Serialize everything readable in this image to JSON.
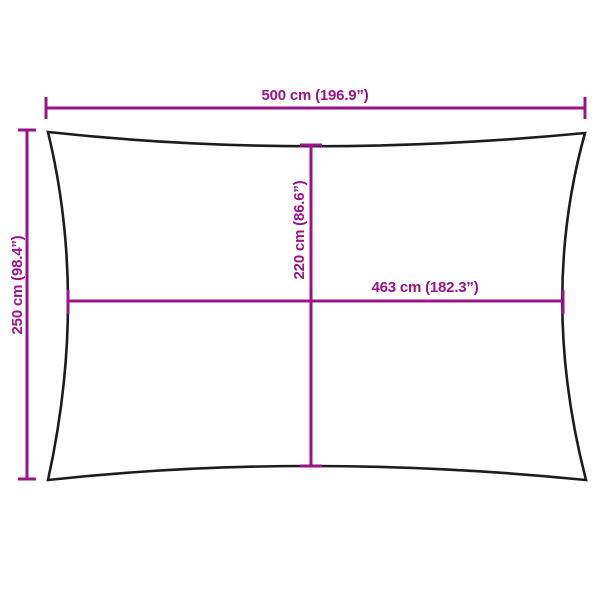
{
  "diagram": {
    "kind": "product-dimension-diagram",
    "labels": {
      "overall_width": "500 cm (196.9”)",
      "overall_height": "250 cm (98.4”)",
      "inner_height": "220 cm (86.6”)",
      "inner_width": "463 cm (182.3”)"
    },
    "measurements": {
      "overall_width_cm": 500,
      "overall_width_in": 196.9,
      "overall_height_cm": 250,
      "overall_height_in": 98.4,
      "inner_height_cm": 220,
      "inner_height_in": 86.6,
      "inner_width_cm": 463,
      "inner_width_in": 182.3
    },
    "colors": {
      "dimension_accent": "#9b1388",
      "outline": "#1c1c1c",
      "background": "#ffffff"
    }
  }
}
